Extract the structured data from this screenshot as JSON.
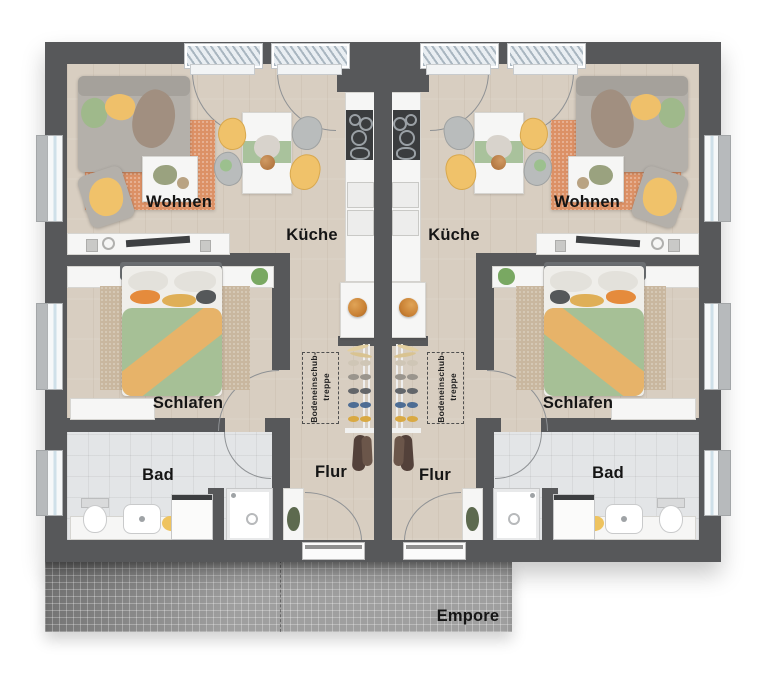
{
  "units": [
    {
      "living": "Wohnen",
      "kitchen": "Küche",
      "bedroom": "Schlafen",
      "bath": "Bad",
      "hall": "Flur",
      "loft_ladder_line1": "Bodeneinschub-",
      "loft_ladder_line2": "treppe"
    },
    {
      "living": "Wohnen",
      "kitchen": "Küche",
      "bedroom": "Schlafen",
      "bath": "Bad",
      "hall": "Flur",
      "loft_ladder_line1": "Bodeneinschub-",
      "loft_ladder_line2": "treppe"
    }
  ],
  "gallery": {
    "label": "Empore"
  },
  "colors": {
    "wall": "#57585a",
    "wood_floor": "#d8cec1",
    "tile_floor": "#e3e5e7",
    "gallery_grid": "#9f9f9f",
    "rug_living": "#dc9166",
    "rug_bedroom": "#c9b79f",
    "duvet_green": "#a6c096",
    "accent_orange": "#e7b369",
    "accent_yellow": "#f0c26a",
    "sofa_gray": "#b3afa9",
    "plant_green": "#79a862",
    "label_text": "#151515"
  }
}
